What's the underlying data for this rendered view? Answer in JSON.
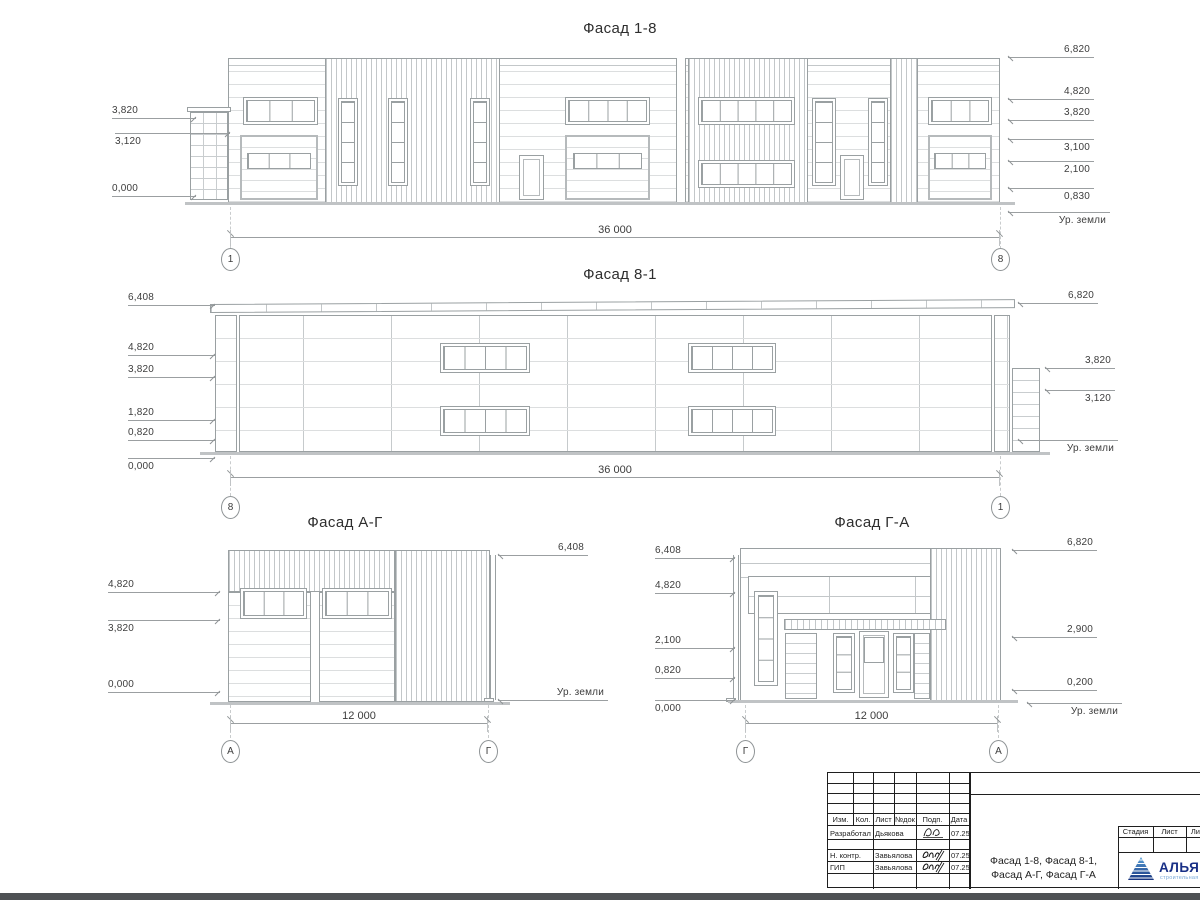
{
  "sheet": {
    "background": "#ffffff",
    "line_color": "#9aa0a2",
    "annotation_text_color": "#3b3b3b",
    "bottom_bar_color": "#4e5154"
  },
  "drawing": {
    "f18": {
      "title": "Фасад 1-8",
      "dim": "36 000",
      "axis_left": "1",
      "axis_right": "8",
      "marks_left": [
        "3,820",
        "3,120",
        "0,000"
      ],
      "marks_right": [
        "6,820",
        "4,820",
        "3,820",
        "3,100",
        "2,100",
        "0,830",
        "Ур. земли"
      ]
    },
    "f81": {
      "title": "Фасад 8-1",
      "dim": "36 000",
      "axis_left": "8",
      "axis_right": "1",
      "marks_left": [
        "6,408",
        "4,820",
        "3,820",
        "1,820",
        "0,820",
        "0,000"
      ],
      "marks_right": [
        "6,820",
        "3,820",
        "3,120",
        "Ур. земли"
      ]
    },
    "fag": {
      "title": "Фасад А-Г",
      "dim": "12 000",
      "axis_left": "А",
      "axis_right": "Г",
      "marks_left": [
        "4,820",
        "3,820",
        "0,000"
      ],
      "marks_right": [
        "6,408",
        "Ур. земли"
      ]
    },
    "fga": {
      "title": "Фасад Г-А",
      "dim": "12 000",
      "axis_left": "Г",
      "axis_right": "А",
      "marks_left": [
        "6,408",
        "4,820",
        "2,100",
        "0,820",
        "0,000"
      ],
      "marks_right": [
        "6,820",
        "2,900",
        "0,200",
        "Ур. земли"
      ]
    }
  },
  "titleblock": {
    "columns": [
      "Изм.",
      "Кол.",
      "Лист",
      "№док",
      "Подп.",
      "Дата"
    ],
    "rows": [
      {
        "role": "Разработал",
        "name": "Дьякова",
        "date": "07.25"
      },
      {
        "role": "Н. контр.",
        "name": "Завьялова",
        "date": "07.25"
      },
      {
        "role": "ГИП",
        "name": "Завьялова",
        "date": "07.25"
      }
    ],
    "doc_title_line1": "Фасад 1-8, Фасад 8-1,",
    "doc_title_line2": "Фасад А-Г, Фасад Г-А",
    "stage_columns": [
      "Стадия",
      "Лист",
      "Листов"
    ],
    "brand": {
      "name": "АЛЬЯНС",
      "tagline": "строительная компания",
      "text_color": "#182f86",
      "triangle_color": "#2e7cc4",
      "tagline_color": "#79a9d9"
    }
  }
}
